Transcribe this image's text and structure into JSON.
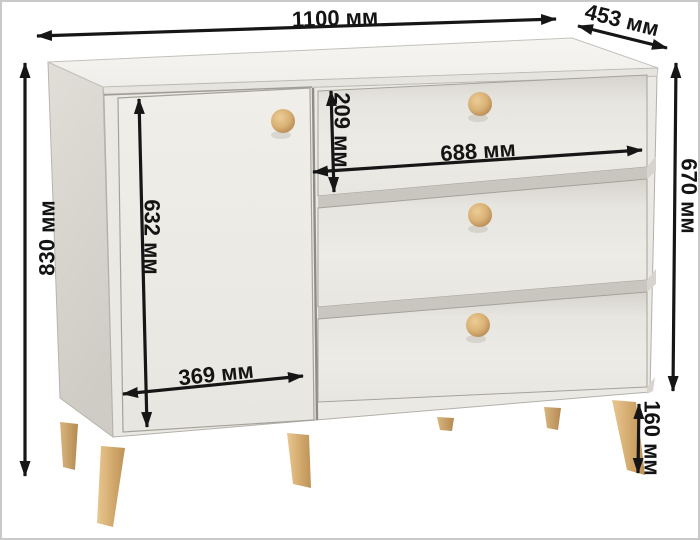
{
  "diagram": {
    "type": "furniture-dimension-diagram",
    "subject": "chest-of-drawers",
    "unit": "мм",
    "ink_color": "#161616",
    "dimensions": {
      "overall_width": {
        "value": 1100,
        "label": "1100 мм"
      },
      "overall_depth": {
        "value": 453,
        "label": "453 мм"
      },
      "overall_height": {
        "value": 830,
        "label": "830 мм"
      },
      "body_height": {
        "value": 670,
        "label": "670 мм"
      },
      "door_height": {
        "value": 632,
        "label": "632 мм"
      },
      "door_width": {
        "value": 369,
        "label": "369 мм"
      },
      "top_drawer_height": {
        "value": 209,
        "label": "209 мм"
      },
      "drawer_width": {
        "value": 688,
        "label": "688 мм"
      },
      "leg_height": {
        "value": 160,
        "label": "160 мм"
      }
    },
    "colors": {
      "background": "#ffffff",
      "frame_border": "#c9c9c9",
      "top_face": "#f4f2ee",
      "front_face": "#ebe9e3",
      "side_panel": "#d6d3cd",
      "groove_shadow": "#c9c6bf",
      "knob_wood": "#dcb478",
      "leg_wood": "#d9b27a"
    }
  }
}
